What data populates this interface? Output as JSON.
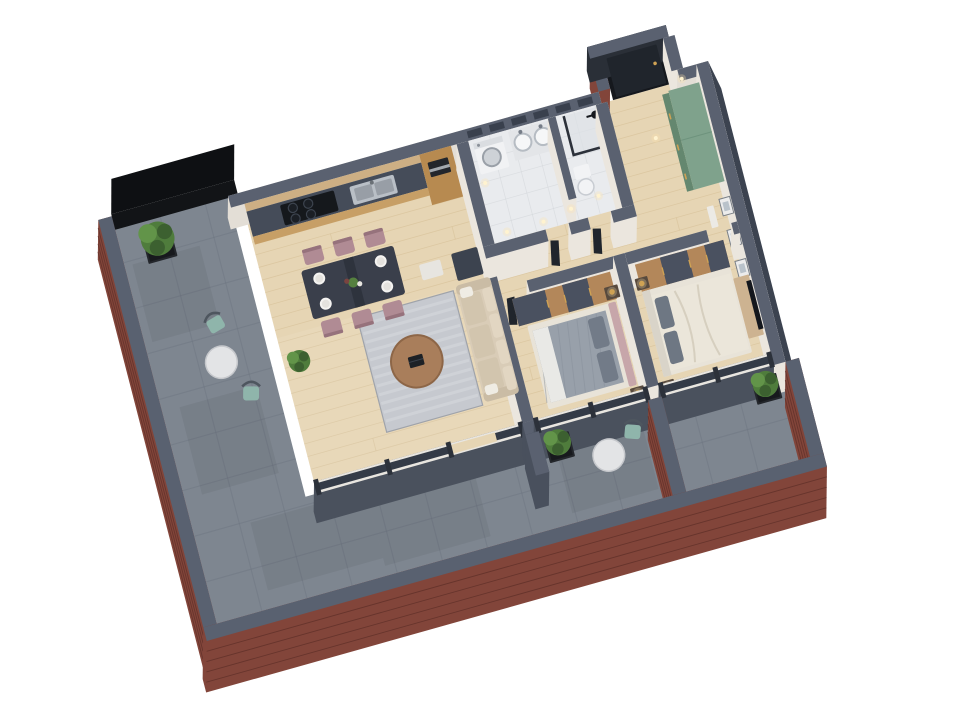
{
  "scene": {
    "label": "3D isometric floor plan render of a two-bedroom apartment with wrap-around brick-walled terrace",
    "type": "isometric-3d-floor-plan",
    "view": "rotated top-down isometric, white background",
    "rooms": [
      {
        "id": "kitchen-dining",
        "label": "Kitchen / Dining",
        "furniture": [
          "kitchen counter with black hob",
          "stainless double sink",
          "tall oven cabinet",
          "dark dining table with six mauve chairs and white plates"
        ]
      },
      {
        "id": "living-room",
        "label": "Living room",
        "furniture": [
          "beige three-seat sofa",
          "grey rug",
          "round wooden coffee table with laptop",
          "white side table",
          "dark media cabinet",
          "potted plant"
        ]
      },
      {
        "id": "bathroom",
        "label": "Bathroom",
        "furniture": [
          "washing machine",
          "double washbasin vanity",
          "toilet",
          "black-framed walk-in shower",
          "warm ceiling spots"
        ]
      },
      {
        "id": "entrance-hall",
        "label": "Entrance hall",
        "furniture": [
          "dark entrance door in alcove",
          "green sideboard",
          "three framed pictures on wall"
        ]
      },
      {
        "id": "bedroom-1",
        "label": "Bedroom 1",
        "furniture": [
          "bed with pink headboard and grey blanket",
          "wood and grey wardrobe",
          "two nightstands with gold pendant lamps"
        ]
      },
      {
        "id": "bedroom-2",
        "label": "Bedroom 2",
        "furniture": [
          "bed with cream duvet and dark pillows",
          "wood and grey wardrobe",
          "two nightstands with gold pendant lamps",
          "TV console with wall TV"
        ]
      },
      {
        "id": "terrace",
        "label": "Wrap-around terrace",
        "furniture": [
          "tree in black planter",
          "round white table with two teal chairs",
          "dark hedge screen",
          "grey concrete tiles"
        ]
      },
      {
        "id": "balconies",
        "label": "Bedroom balconies",
        "furniture": [
          "round white bistro table with teal chair",
          "two shrub planters",
          "brick divider wall"
        ]
      }
    ]
  },
  "colors": {
    "wall_top": "#5a6170",
    "wall_face": "#49505d",
    "wall_white": "#ebe6de",
    "brick": "#82453a",
    "brick_dark": "#5e2f28",
    "coping": "#596170",
    "terrace": "#7e8690",
    "terrace_line": "#6e7681",
    "wood": "#e6d5b4",
    "wood_line": "#d4bd93",
    "marble": "#e9ebee",
    "marble_line": "#d3d6da",
    "slate_dark": "#2c313a",
    "glass": "#343b47",
    "cabinet_wood": "#c79f66",
    "cabinet_tall": "#b78a50",
    "counter": "#454c59",
    "steel": "#b9bfc6",
    "table_dark": "#3a3f4b",
    "chair_mauve": "#b08b94",
    "plate": "#f4f3f1",
    "sofa": "#d9ccb7",
    "sofa_shade": "#cabca5",
    "pillow_light": "#efece4",
    "rug": "#c6c9cf",
    "rug_light": "#d9dbe0",
    "rug_dark": "#a9adb5",
    "coffee": "#a97e5b",
    "green_cab": "#7fa28c",
    "green_cab_face": "#64876f",
    "bed_frame": "#e8e3d8",
    "bed1_blanket": "#98a0aa",
    "bed1_sheet": "#e9e9e6",
    "headboard_pink": "#c7a6aa",
    "bed2_duvet": "#ebe6da",
    "pillow_dark": "#6e7783",
    "wardrobe_wood": "#b3875a",
    "wardrobe_grey": "#4a5160",
    "nightstand": "#584a3e",
    "gold": "#cfa254",
    "teal": "#8fb5ab",
    "teal_frame": "#4e565f",
    "white_table": "#e3e4e6",
    "plant_dark": "#3c6030",
    "plant_mid": "#4f7c3c",
    "plant_light": "#629449",
    "planter": "#24272c",
    "door_dark": "#20252c",
    "hedge": "#121417",
    "light_warm": "#ffe6ae",
    "background": "#ffffff"
  }
}
